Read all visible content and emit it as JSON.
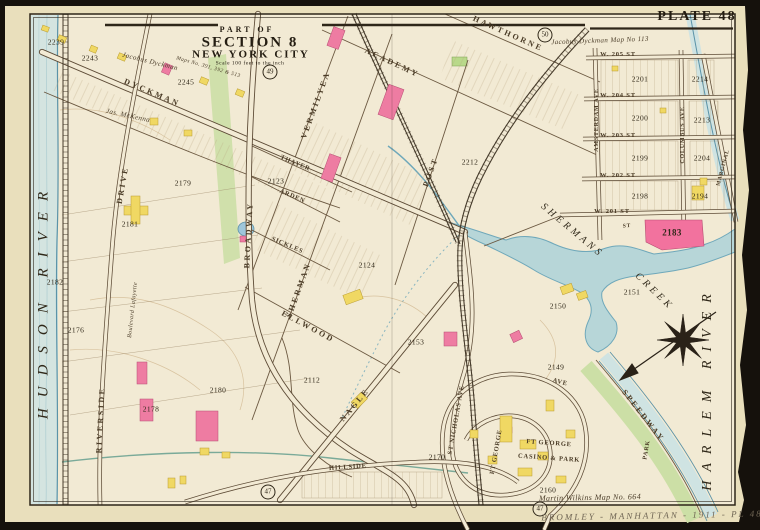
{
  "palette": {
    "paper": "#e9dfbc",
    "field": "#f2ead4",
    "water": "#b7d6d8",
    "shore": "#5b93a8",
    "park_green": "#ccdfa6",
    "building_pink": "#ee7ca2",
    "building_yellow": "#f0d863",
    "block_pink": "#f2729e",
    "ink": "#3b2f1e"
  },
  "header": {
    "plate": "PLATE 48"
  },
  "title_block": {
    "part_of": "PART OF",
    "section": "SECTION 8",
    "city": "NEW YORK CITY",
    "scale": "Scale 100 feet to the inch"
  },
  "plate_refs": {
    "r49": "49",
    "r50": "50",
    "r47a": "47",
    "r47b": "47"
  },
  "water": {
    "hudson": "HUDSON RIVER",
    "harlem": "HARLEM RIVER",
    "creek_line1": "SHERMANS",
    "creek_line2": "CREEK"
  },
  "streets": {
    "dyckman": "DYCKMAN",
    "hawthorne": "HAWTHORNE",
    "academy": "ACADEMY",
    "vermilyea": "VERMILYEA",
    "sherman": "SHERMAN",
    "post": "POST",
    "ellwood": "ELLWOOD",
    "nagle": "NAGLE",
    "thayer": "THAYER",
    "arden": "ARDEN",
    "sickles": "SICKLES",
    "broadway": "BROADWAY",
    "riverside": "RIVERSIDE",
    "drive": "DRIVE",
    "st_nicholas": "ST NICHOLAS AVE",
    "ft_george_ave": "FT GEORGE",
    "hillside": "HILLSIDE",
    "speedway": "SPEEDWAY",
    "amsterdam": "AMSTERDAM AVE",
    "columbus": "COLUMBUS AVE",
    "marginal": "MARGINAL",
    "ave": "AVE",
    "st_short": "ST",
    "w205": "W. 205 ST",
    "w204": "W. 204 ST",
    "w203": "W. 203 ST",
    "w202": "W. 202 ST",
    "w201": "W. 201 ST"
  },
  "places": {
    "ft_george": "FT GEORGE",
    "casino": "CASINO & PARK",
    "park": "PARK"
  },
  "blocks": {
    "b2239": "2239",
    "b2243": "2243",
    "b2245": "2245",
    "b2123": "2123",
    "b2124": "2124",
    "b2112": "2112",
    "b2153": "2153",
    "b2176": "2176",
    "b2179": "2179",
    "b2180": "2180",
    "b2181": "2181",
    "b2182": "2182",
    "b2178": "2178",
    "b2149": "2149",
    "b2150": "2150",
    "b2151": "2151",
    "b2160": "2160",
    "b2170": "2170",
    "b2183": "2183",
    "b2198": "2198",
    "b2199": "2199",
    "b2200": "2200",
    "b2201": "2201",
    "b2194": "2194",
    "b2204": "2204",
    "b2213": "2213",
    "b2214": "2214",
    "b2212": "2212"
  },
  "notes": {
    "map113": "Jacobus Dyckman  Map No 113",
    "dyckman_owner": "Jacobus Dyckman",
    "mckenna": "Jas. McKenna",
    "maps391": "Maps No. 391, 392 & 513",
    "wilkins": "Martin Wilkins Map No. 664",
    "lafayette": "Boulevard Lafayette",
    "pencil": "BROMLEY - MANHATTAN - 1911 - PL 48"
  }
}
